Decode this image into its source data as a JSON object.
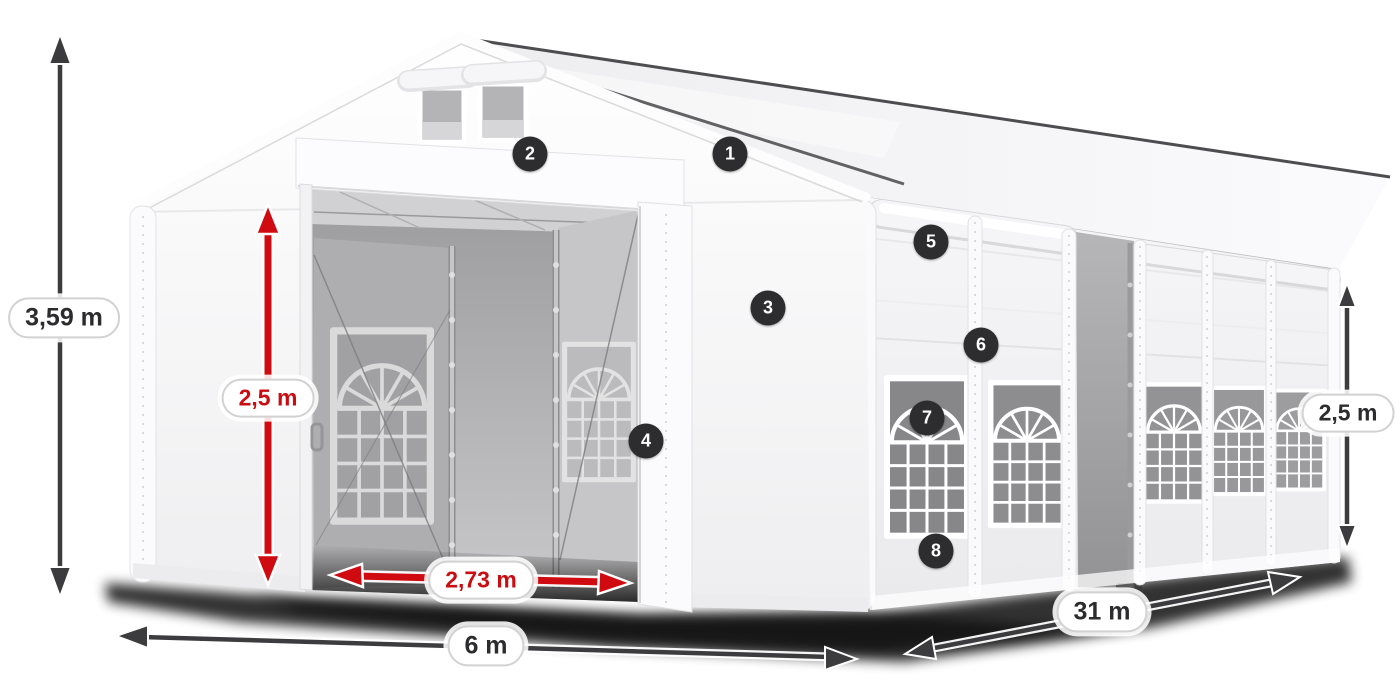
{
  "diagram": {
    "title": "tent-dimensions-figure",
    "measurements": {
      "total_height": "3,59 m",
      "entrance_height": "2,5 m",
      "entrance_width": "2,73 m",
      "base_width": "6 m",
      "length": "31 m",
      "side_height": "2,5 m"
    },
    "badges": [
      {
        "number": "1"
      },
      {
        "number": "2"
      },
      {
        "number": "3"
      },
      {
        "number": "4"
      },
      {
        "number": "5"
      },
      {
        "number": "6"
      },
      {
        "number": "7"
      },
      {
        "number": "8"
      }
    ],
    "colors": {
      "accent_red": "#cf0a10",
      "arrow_dark": "#3c3c3e",
      "badge_bg": "#2d2d2f",
      "label_text": "#2c2c2e",
      "pill_border": "#d2d2d2",
      "tent_white": "#f7f7f9",
      "interior_gray": "#9b9b9d"
    }
  }
}
